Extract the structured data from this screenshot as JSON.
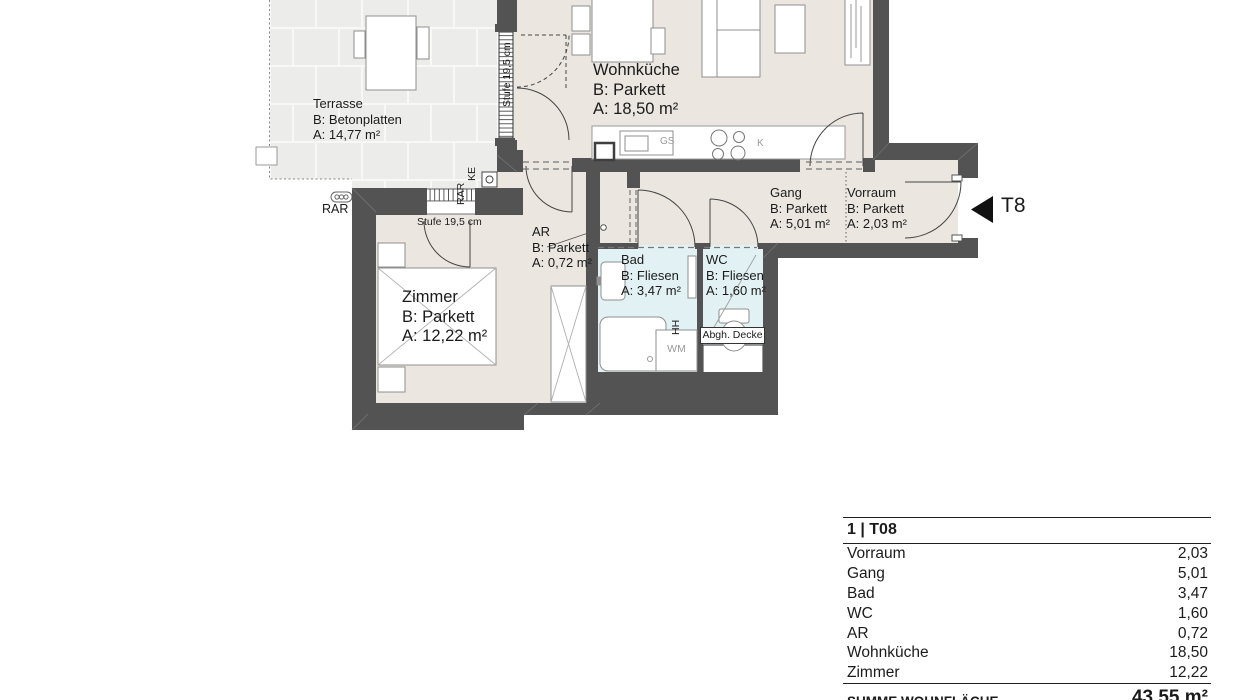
{
  "plan": {
    "rooms": {
      "terrasse": {
        "name": "Terrasse",
        "floor": "B: Betonplatten",
        "area": "A: 14,77 m²"
      },
      "wohnkueche": {
        "name": "Wohnküche",
        "floor": "B: Parkett",
        "area": "A: 18,50 m²"
      },
      "zimmer": {
        "name": "Zimmer",
        "floor": "B: Parkett",
        "area": "A: 12,22 m²"
      },
      "gang": {
        "name": "Gang",
        "floor": "B: Parkett",
        "area": "A: 5,01 m²"
      },
      "vorraum": {
        "name": "Vorraum",
        "floor": "B: Parkett",
        "area": "A: 2,03 m²"
      },
      "ar": {
        "name": "AR",
        "floor": "B: Parkett",
        "area": "A: 0,72 m²"
      },
      "bad": {
        "name": "Bad",
        "floor": "B: Fliesen",
        "area": "A: 3,47 m²"
      },
      "wc": {
        "name": "WC",
        "floor": "B: Fliesen",
        "area": "A: 1,60 m²"
      }
    },
    "annotations": {
      "stufe_window": "Stufe 19,5 cm",
      "stufe_steps": "Stufe 19,5 cm",
      "rar_bottom": "RAR",
      "rar_side": "RAR",
      "ke": "KE",
      "hh": "HH",
      "abgh_decke": "Abgh. Decke",
      "wm": "WM",
      "gs": "GS",
      "k": "K",
      "unit_door": "T8"
    },
    "colors": {
      "wall": "#535353",
      "floor": "#ebe7e0",
      "wet_room": "#e2f1f3",
      "tile": "#ececeb"
    }
  },
  "table": {
    "title": "1 | T08",
    "rows": [
      [
        "Vorraum",
        "2,03"
      ],
      [
        "Gang",
        "5,01"
      ],
      [
        "Bad",
        "3,47"
      ],
      [
        "WC",
        "1,60"
      ],
      [
        "AR",
        "0,72"
      ],
      [
        "Wohnküche",
        "18,50"
      ],
      [
        "Zimmer",
        "12,22"
      ]
    ],
    "total_label": "SUMME WOHNFLÄCHE",
    "total_value": "43,55 m²"
  }
}
